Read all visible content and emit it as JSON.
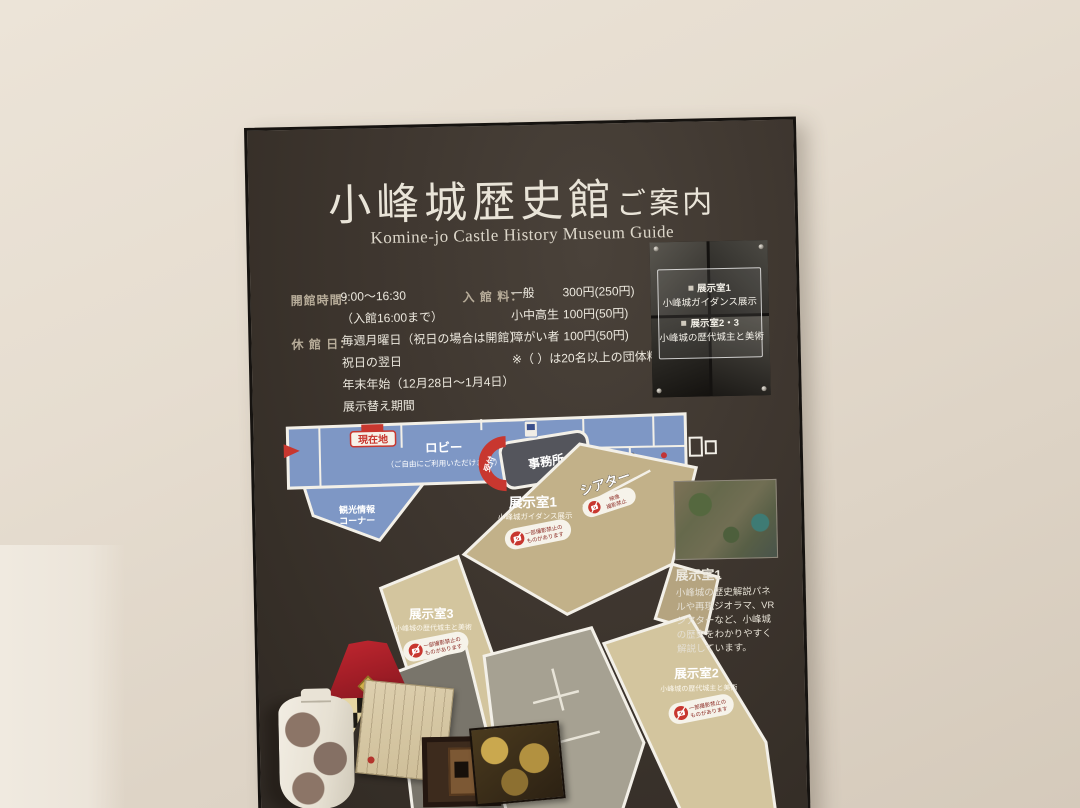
{
  "sign": {
    "title": "小峰城歴史館",
    "title_suffix": "ご案内",
    "subtitle": "Komine-jo Castle History Museum Guide",
    "info": {
      "hours_label": "開館時間：",
      "hours_value": "9:00〜16:30",
      "hours_note": "（入館16:00まで）",
      "closed_label": "休 館 日：",
      "closed_lines": [
        "毎週月曜日（祝日の場合は開館）",
        "祝日の翌日",
        "年末年始（12月28日〜1月4日）",
        "展示替え期間"
      ],
      "admission_label": "入 館 料：",
      "admission_rows": [
        {
          "item": "一般",
          "price": "300円(250円)"
        },
        {
          "item": "小中高生",
          "price": "100円(50円)"
        },
        {
          "item": "障がい者",
          "price": "100円(50円)"
        }
      ],
      "admission_note": "※（ ）は20名以上の団体料金"
    },
    "photo_panel": {
      "lines": [
        "展示室1",
        "小峰城ガイダンス展示",
        "展示室2・3",
        "小峰城の歴代城主と美術"
      ]
    },
    "map": {
      "you_are_here": "現在地",
      "lobby": "ロビー",
      "lobby_note": "（ご自由にご利用いただけます。）",
      "info_corner_1": "観光情報",
      "info_corner_2": "コーナー",
      "office": "事務所",
      "reception": "受付",
      "theater": "シアター",
      "theater_np_1": "映像",
      "theater_np_2": "撮影禁止",
      "room1": "展示室1",
      "room1_sub": "小峰城ガイダンス展示",
      "room2": "展示室2",
      "room2_sub": "小峰城の歴代城主と美術",
      "room3": "展示室3",
      "room3_sub": "小峰城の歴代城主と美術",
      "np_1": "一部撮影禁止の",
      "np_2": "ものがあります"
    },
    "room1_detail": {
      "title": "展示室1",
      "description": "小峰城の歴史解説パネルや再現ジオラマ、VRシアターなど、小峰城の歴史をわかりやすく解説しています。"
    },
    "colors": {
      "accent_red": "#c8372f",
      "map_blue": "#7e97c5",
      "map_tan": "#c2b189",
      "board_brown": "#3e362f"
    }
  }
}
